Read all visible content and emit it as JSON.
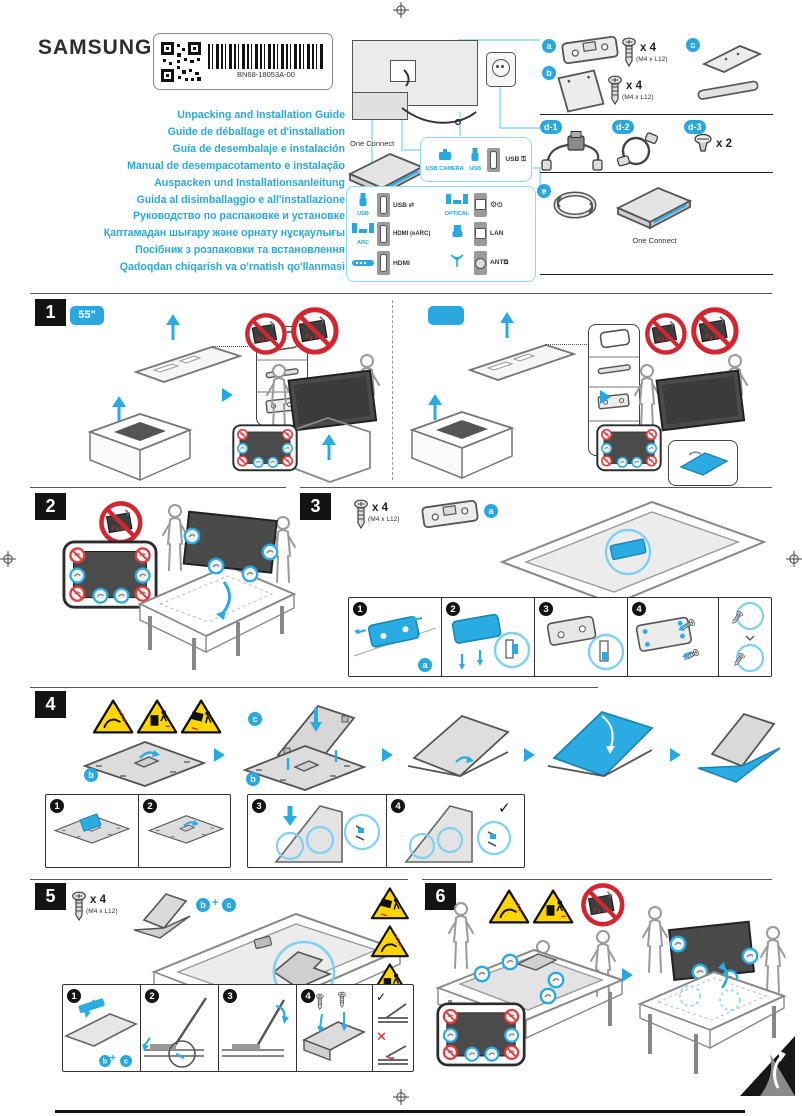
{
  "brand": "SAMSUNG",
  "label": {
    "part_number": "BN68-18053A-00"
  },
  "titles": [
    "Unpacking and Installation Guide",
    "Guide de déballage et d'installation",
    "Guía de desembalaje e instalación",
    "Manual de desempacotamento e instalação",
    "Auspacken und Installationsanleitung",
    "Guida al disimballaggio e all'installazione",
    "Руководство по распаковке и установке",
    "Қаптамадан шығару және орнату нұсқаулығы",
    "Посібник з розпаковки та встановлення",
    "Qadoqdan chiqarish va o'rnatish qo'llanmasi"
  ],
  "diagram": {
    "one_connect": "One Connect",
    "ports_top": {
      "src1": "USB CAMERA",
      "src2": "USB",
      "out": "USB"
    },
    "ports_grid": {
      "usb_src": "USB",
      "usb_out": "USB",
      "arc_src": "ARC",
      "arc_out": "HDMI (eARC)",
      "hdmi_out": "HDMI",
      "optical_src": "OPTICAL",
      "lan_out": "LAN",
      "ant_out": "ANT"
    }
  },
  "parts": {
    "a": "a",
    "b": "b",
    "c": "c",
    "d1": "d-1",
    "d2": "d-2",
    "d3": "d-3",
    "e": "e",
    "screw_qty": "x 4",
    "screw_spec": "(M4 x L12)",
    "d3_qty": "x 2",
    "e_caption": "One Connect"
  },
  "icons": {
    "settings": "⚙",
    "check": "✓",
    "cross": "✕",
    "plus": "+"
  },
  "sections": {
    "s1": {
      "num": "1",
      "size": "55\""
    },
    "s2": {
      "num": "2"
    },
    "s3": {
      "num": "3",
      "screw_qty": "x 4",
      "screw_spec": "(M4 x L12)",
      "part": "a",
      "steps": [
        "1",
        "2",
        "3",
        "4"
      ]
    },
    "s4": {
      "num": "4",
      "part_b": "b",
      "part_c": "c",
      "steps": [
        "1",
        "2",
        "3",
        "4"
      ]
    },
    "s5": {
      "num": "5",
      "screw_qty": "x 4",
      "screw_spec": "(M4 x L12)",
      "part_b": "b",
      "part_c": "c",
      "steps": [
        "1",
        "2",
        "3",
        "4"
      ]
    },
    "s6": {
      "num": "6"
    }
  }
}
